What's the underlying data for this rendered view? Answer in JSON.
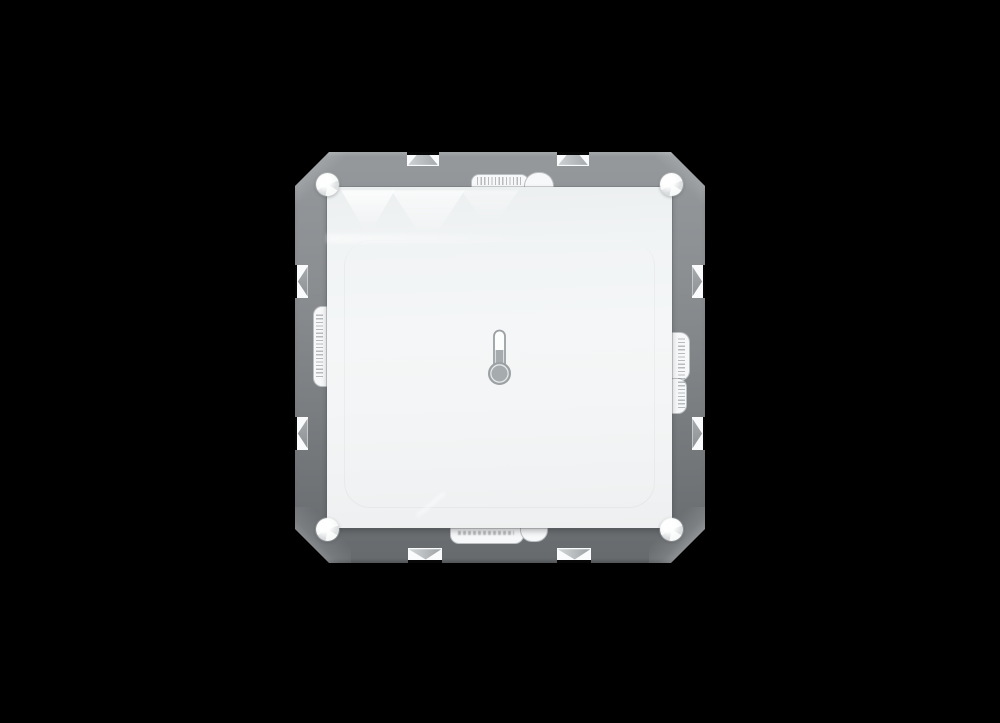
{
  "scene": {
    "description": "Product photo of a flush-mounted wall temperature sensor on a black background",
    "background": "#000000"
  },
  "device": {
    "mounting_frame": {
      "color_top": "#95999c",
      "color_bottom": "#666a6d"
    },
    "cover_plate": {
      "color": "#f4f6f7"
    },
    "screw_count": 4,
    "icon": {
      "name": "thermometer-icon",
      "stroke": "#9ba0a3",
      "fill": "#a6abae",
      "tube": "#fcfdfd"
    }
  }
}
